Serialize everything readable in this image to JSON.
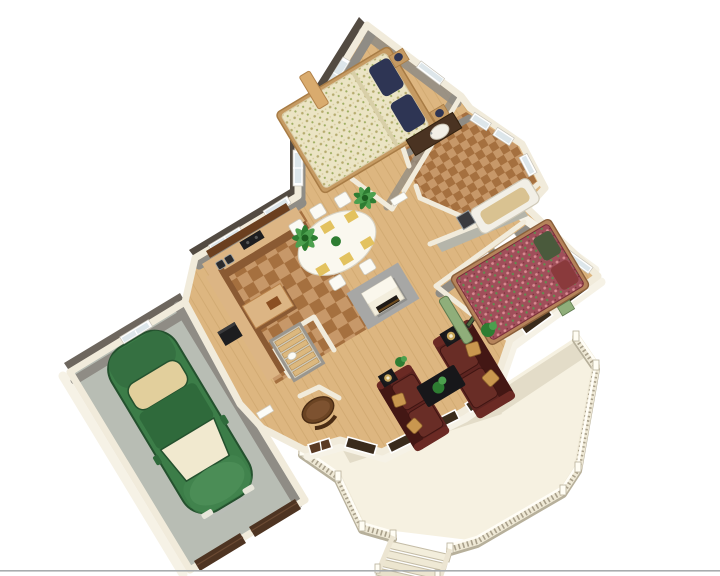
{
  "scene": {
    "description": "3D isometric cutaway rendering of a single-story house floor plan, rotated roughly 31 degrees, on a white background with a thin gray rule at the bottom edge",
    "background": "#ffffff",
    "footer_line_color": "#a8acae"
  },
  "palette": {
    "bg_white": "#ffffff",
    "wall_top": "#f1ebdb",
    "wall_inner": "#8f8c85",
    "wall_dark_face": "#534b42",
    "wall_light_face": "#f6f2e6",
    "wood_floor": "#ddb680",
    "wood_grain": "#c59c63",
    "tile_light": "#c79869",
    "tile_dark": "#a5703f",
    "garage_floor": "#b8bdb4",
    "garage_door_brown": "#4e3422",
    "garage_door_slat": "#6b4a33",
    "deck_floor": "#f6f1e1",
    "deck_shadow": "#e3dcc8",
    "railing_cream": "#efe9d6",
    "railing_shadow": "#b7b09b",
    "car_green": "#3c7d48",
    "car_green_dark": "#24512e",
    "car_glass": "#e2cf9c",
    "car_windshield": "#f1e9cf",
    "sofa_burgundy": "#5d2420",
    "sofa_burgundy_dark": "#431714",
    "pillow_gold": "#c9974f",
    "table_black": "#17171a",
    "lamp_gold": "#c9a85c",
    "plant_green": "#2e7d32",
    "plant_green_light": "#4ca04e",
    "fireplace_cream": "#f3eedd",
    "fireplace_pad": "#a7a7a5",
    "counter_tan": "#dcb584",
    "cabinet_brown": "#8a5a33",
    "cabinet_dark": "#6b3f1f",
    "appliance_black": "#1d1d1f",
    "dining_table_white": "#faf8ef",
    "placemat_gold": "#e3c25f",
    "bed_frame_tan": "#c59a62",
    "master_spread": "#ebe4c4",
    "master_pillow": "#2e3554",
    "bed2_spread": "#a04f5a",
    "bed2_frame": "#b5835a",
    "bench_tan": "#d9ab6e",
    "bench_green": "#8fae7a",
    "vanity_brown": "#4a3322",
    "tub_white": "#f2efe6",
    "tub_inner_tan": "#d9c291",
    "window_glass": "#dde6ea",
    "window_frame": "#ffffff",
    "window_dark": "#3a2b1c",
    "door_brown": "#5a3a24",
    "closet_interior": "#b5b5aa",
    "stair_tread": "#dcb87e",
    "nook_table_brown": "#6b4423"
  },
  "rooms": [
    {
      "name": "master-bedroom",
      "furniture": [
        "floral double bed with navy pillows",
        "two nightstands with lamps",
        "tan bench"
      ]
    },
    {
      "name": "bathroom",
      "furniture": [
        "bathtub",
        "dark vanity with oval sink",
        "shower pan",
        "mirror"
      ]
    },
    {
      "name": "bedroom-2",
      "furniture": [
        "red floral double bed",
        "green bench",
        "potted plant",
        "closet with white doors"
      ]
    },
    {
      "name": "living-room",
      "furniture": [
        "two burgundy sofas with gold pillows",
        "black coffee table with plant",
        "two end tables with lamps",
        "fireplace"
      ]
    },
    {
      "name": "dining-room",
      "furniture": [
        "white oval table",
        "yellow placemats",
        "white chairs",
        "two palm plants"
      ]
    },
    {
      "name": "kitchen",
      "furniture": [
        "L-shaped tan counters",
        "island",
        "black cooktop",
        "black refrigerator",
        "double sink"
      ]
    },
    {
      "name": "entry",
      "furniture": [
        "round pedestal table",
        "basement stairs",
        "front door"
      ]
    },
    {
      "name": "garage",
      "furniture": [
        "green sedan",
        "two brown garage door panels"
      ]
    },
    {
      "name": "deck",
      "furniture": [
        "balustrade railing",
        "exterior staircase"
      ]
    }
  ]
}
